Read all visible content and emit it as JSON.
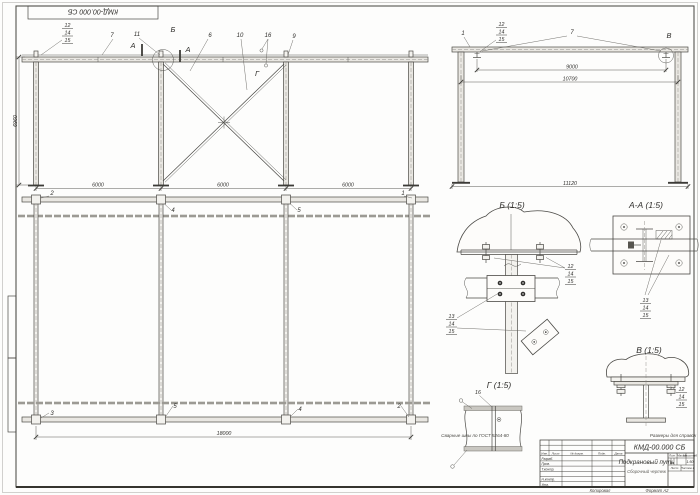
{
  "sheet": {
    "stamp": "КМД-00.000 СБ",
    "copied": "Копировал",
    "format": "Формат А2"
  },
  "notes": {
    "welds": "Сварные швы по ГОСТ 5264-80",
    "reference": "Размеры для справок"
  },
  "title_block": {
    "doc_number": "КМД-00.000 СБ",
    "title": "Подкрановый путь",
    "subtitle": "Сборочный чертеж",
    "header_cols": [
      "Изм.",
      "Лист",
      "№ докум.",
      "Подп.",
      "Дата"
    ],
    "roles": [
      "Разраб.",
      "Пров.",
      "Т.контр.",
      "Н.контр.",
      "Утв."
    ],
    "lit_label": "Лит.",
    "mass_label": "Масса",
    "scale_label": "Масштаб",
    "scale_value": "1:50",
    "sheet_cell": "Лист",
    "sheets_cell": "Листов 1"
  },
  "annotations": [
    {
      "t": "7",
      "x": 112,
      "y": 37
    },
    {
      "t": "11",
      "x": 137,
      "y": 36
    },
    {
      "t": "А",
      "x": 133,
      "y": 48,
      "c": "ltr"
    },
    {
      "t": "А",
      "x": 188,
      "y": 52,
      "c": "ltr"
    },
    {
      "t": "Б",
      "x": 173,
      "y": 32,
      "c": "ltr"
    },
    {
      "t": "6",
      "x": 210,
      "y": 37
    },
    {
      "t": "10",
      "x": 240,
      "y": 37
    },
    {
      "t": "16",
      "x": 268,
      "y": 37
    },
    {
      "t": "9",
      "x": 294,
      "y": 38
    },
    {
      "t": "Г",
      "x": 257,
      "y": 76,
      "c": "ltr"
    },
    {
      "t": "6000",
      "x": 98,
      "y": 186.5,
      "c": "dim"
    },
    {
      "t": "6000",
      "x": 223,
      "y": 186.5,
      "c": "dim"
    },
    {
      "t": "6000",
      "x": 348,
      "y": 186.5,
      "c": "dim"
    },
    {
      "t": "6960",
      "x": 17,
      "y": 121,
      "c": "dim",
      "r": -90
    },
    {
      "t": "2",
      "x": 52,
      "y": 195
    },
    {
      "t": "4",
      "x": 173,
      "y": 212
    },
    {
      "t": "5",
      "x": 299,
      "y": 212
    },
    {
      "t": "1",
      "x": 403,
      "y": 195
    },
    {
      "t": "3",
      "x": 52,
      "y": 415
    },
    {
      "t": "5",
      "x": 175,
      "y": 408
    },
    {
      "t": "4",
      "x": 300,
      "y": 411
    },
    {
      "t": "2",
      "x": 399,
      "y": 408
    },
    {
      "t": "18000",
      "x": 224,
      "y": 435,
      "c": "dim"
    },
    {
      "t": "1",
      "x": 463,
      "y": 35
    },
    {
      "t": "7",
      "x": 572,
      "y": 34
    },
    {
      "t": "В",
      "x": 669,
      "y": 38,
      "c": "ltr"
    },
    {
      "t": "9000",
      "x": 572,
      "y": 68.5,
      "c": "dim"
    },
    {
      "t": "10700",
      "x": 570,
      "y": 80.5,
      "c": "dim"
    },
    {
      "t": "11120",
      "x": 570,
      "y": 185,
      "c": "dim"
    },
    {
      "t": "Б (1:5)",
      "x": 512,
      "y": 208,
      "c": "vt"
    },
    {
      "t": "А-А (1:5)",
      "x": 646,
      "y": 208,
      "c": "vt"
    },
    {
      "t": "Г (1:5)",
      "x": 499,
      "y": 388,
      "c": "vt"
    },
    {
      "t": "В (1:5)",
      "x": 649,
      "y": 353,
      "c": "vt"
    },
    {
      "t": "16",
      "x": 478,
      "y": 394,
      "c": "dim"
    }
  ],
  "stacks": [
    {
      "x": 62,
      "y": 21,
      "items": [
        "12",
        "14",
        "15"
      ]
    },
    {
      "x": 496,
      "y": 20,
      "items": [
        "12",
        "14",
        "15"
      ]
    },
    {
      "x": 565,
      "y": 262,
      "items": [
        "12",
        "14",
        "15"
      ]
    },
    {
      "x": 446,
      "y": 312,
      "items": [
        "13",
        "14",
        "15"
      ]
    },
    {
      "x": 640,
      "y": 296,
      "items": [
        "13",
        "14",
        "15"
      ]
    },
    {
      "x": 676,
      "y": 385,
      "items": [
        "12",
        "14",
        "15"
      ]
    }
  ]
}
